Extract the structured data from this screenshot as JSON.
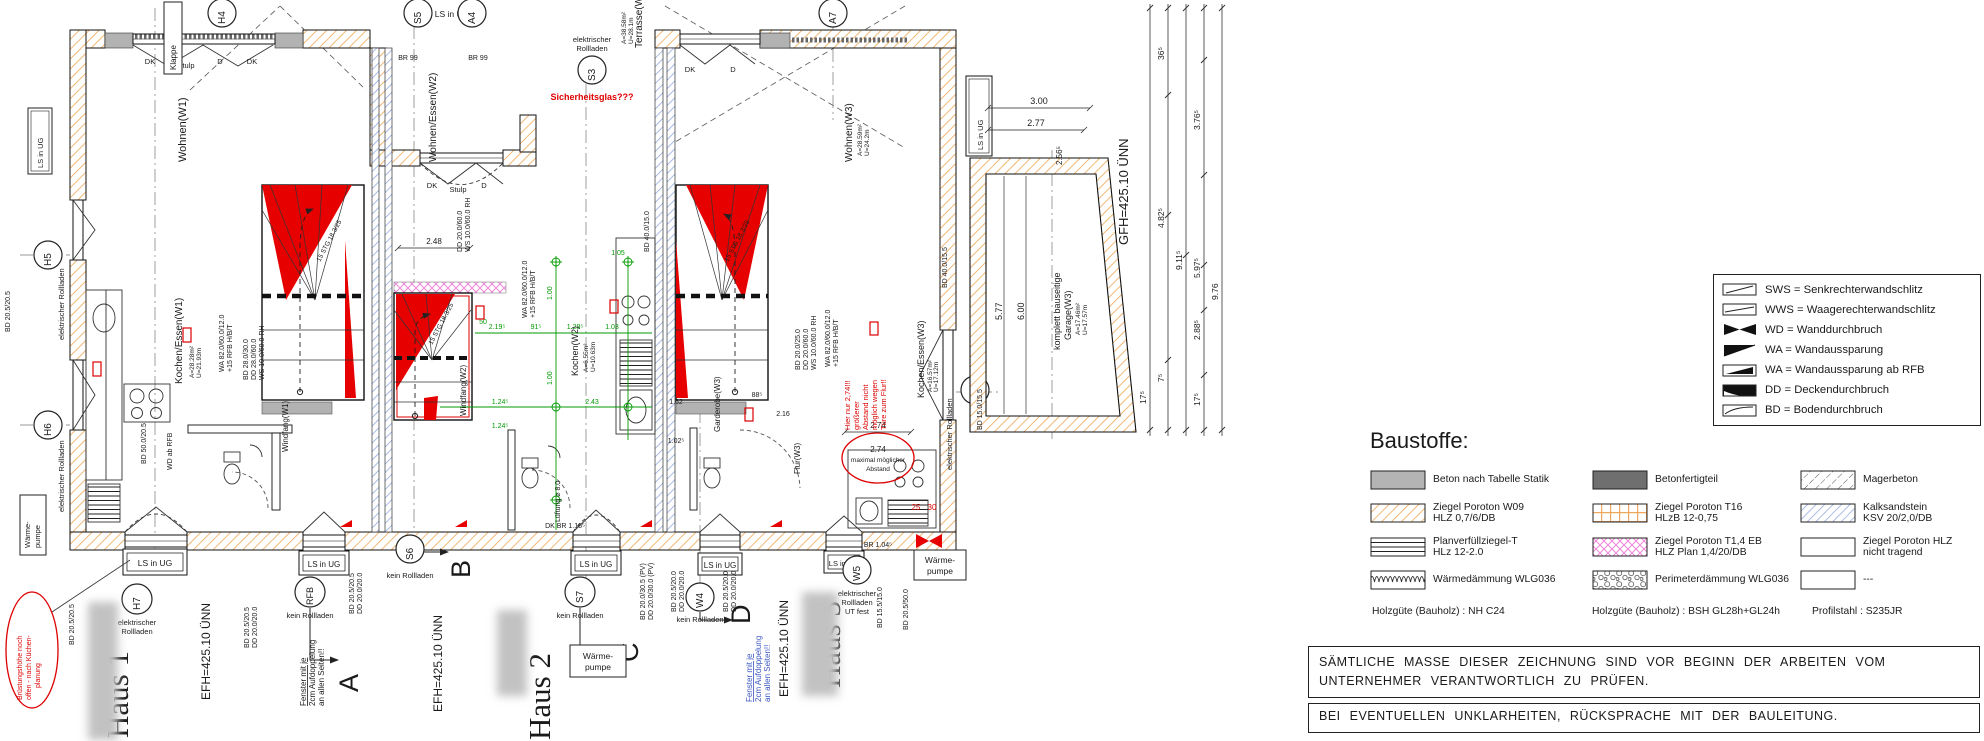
{
  "legend": {
    "rows": [
      {
        "label": "SWS = Senkrechterwandschlitz"
      },
      {
        "label": "WWS = Waagerechterwandschlitz"
      },
      {
        "label": "WD = Wanddurchbruch"
      },
      {
        "label": "WA = Wandaussparung"
      },
      {
        "label": "WA = Wandaussparung ab RFB"
      },
      {
        "label": "DD = Deckendurchbruch"
      },
      {
        "label": "BD = Bodendurchbruch"
      }
    ]
  },
  "baustoffe": {
    "heading": "Baustoffe:",
    "cells": [
      {
        "l1": "Beton nach Tabelle Statik",
        "l2": ""
      },
      {
        "l1": "Betonfertigteil",
        "l2": ""
      },
      {
        "l1": "Magerbeton",
        "l2": ""
      },
      {
        "l1": "Ziegel Poroton W09",
        "l2": "HLZ 0,7/6/DB"
      },
      {
        "l1": "Ziegel Poroton T16",
        "l2": "HLzB 12-0,75"
      },
      {
        "l1": "Kalksandstein",
        "l2": "KSV 20/2,0/DB"
      },
      {
        "l1": "Planverfüllziegel-T",
        "l2": "HLz 12-2.0"
      },
      {
        "l1": "Ziegel Poroton T1,4 EB",
        "l2": "HLZ Plan 1,4/20/DB"
      },
      {
        "l1": "Ziegel Poroton HLZ",
        "l2": "nicht tragend"
      },
      {
        "l1": "Wärmedämmung WLG036",
        "l2": ""
      },
      {
        "l1": "Perimeterdämmung WLG036",
        "l2": ""
      },
      {
        "l1": "---",
        "l2": ""
      }
    ],
    "footer": [
      "Holzgüte (Bauholz) : NH C24",
      "Holzgüte (Bauholz) : BSH GL28h+GL24h",
      "Profilstahl : S235JR"
    ]
  },
  "notes": {
    "l1": "SÄMTLICHE MASSE DIESER ZEICHNUNG SIND VOR BEGINN DER ARBEITEN VOM",
    "l2": "UNTERNEHMER VERANTWORTLICH ZU PRÜFEN.",
    "l3": "BEI EVENTUELLEN UNKLARHEITEN, RÜCKSPRACHE MIT DER BAULEITUNG."
  },
  "plan": {
    "houses": [
      {
        "name": "Haus 1",
        "efh": "EFH=425.10 ÜNN"
      },
      {
        "name": "Haus 2",
        "efh": "EFH=425.10 ÜNN"
      },
      {
        "name": "Haus 3",
        "efh": "EFH=425.10 ÜNN"
      }
    ],
    "garage": {
      "gfh": "GFH=425.10 ÜNN",
      "l1": "komplett bauseitige",
      "l2": "Garage(W3)",
      "a": "A=17.46m²",
      "u": "U=17.57m"
    },
    "rooms": {
      "wohnen1": "Wohnen(W1)",
      "ke1": "Kochen/Essen(W1)",
      "ke1a": "A=28.28m²",
      "ke1u": "U=21.93m",
      "wf1": "Windfang(W1)",
      "we2": "Wohnen/Essen(W2)",
      "ko2": "Kochen(W2)",
      "ko2a": "A=6.55m²",
      "ko2u": "U=10.63m",
      "wf2": "Windfang(W2)",
      "terrasse": "Terrasse(W2)",
      "terra": "A=38.58m²",
      "terru": "U=28.1m",
      "wohnen3": "Wohnen(W3)",
      "w3a": "A=28.59m²",
      "w3u": "U=24.2m",
      "ke3": "Kochen/Essen(W3)",
      "ke3a": "A=16.57m²",
      "ke3u": "U=17.12m",
      "gard3": "Garderobe(W3)",
      "flur3": "Flur(W3)"
    },
    "circles": {
      "h4": "H4",
      "s5": "S5",
      "a4": "A4",
      "s3": "S3",
      "a7": "A7",
      "h5": "H5",
      "h6": "H6",
      "h7": "H7",
      "rfb": "RFB",
      "s6": "S6",
      "s7": "S7",
      "w4": "W4",
      "w5": "W5",
      "w6": "W6"
    },
    "captions": {
      "elektr1": "elektrischer",
      "elektr2": "Rollladen",
      "kein": "kein Rollladen",
      "utfest": "UT fest",
      "elektr": "elektrischer Rollladen"
    },
    "boxes": {
      "ls": "LS in UG",
      "wp1": "Wärme-",
      "wp2": "pumpe",
      "klappe": "Klappe"
    },
    "sections": {
      "a": "A",
      "b": "B",
      "c": "C",
      "d": "D"
    },
    "win": {
      "dk": "DK",
      "stulp": "Stulp",
      "d": "D",
      "br99": "BR 99",
      "br116": "DK BR 1.16⁵",
      "br104": "BR 1.04⁵"
    },
    "stair": {
      "label": "15 STG 18.3/25"
    },
    "red": {
      "glas": "Sicherheitsglas???",
      "h1": "Hier nur 2,74!!!",
      "h2": "größerer",
      "h3": "Abstand nicht",
      "h4": "möglich wegen",
      "h5": "Türe zum Flur!!",
      "c1": "Brüstungshöhe noch",
      "c2": "offen - nach Küchen-",
      "c3": "planung",
      "m1": "maximal möglicher",
      "m2": "Abstand",
      "d25": "25",
      "d30": "30"
    },
    "fenster": {
      "l1": "Fenster mit je",
      "l2": "2cm Aufdoppelung",
      "l3": "an allen Seiten!!"
    },
    "codes": {
      "bd2055": "BD 20.5/20.5",
      "dd2020": "DD 20.0/20.0",
      "bdpv": "BD 20.0/30.5 (PV)",
      "ddpv": "DD 20.0/30.0 (PV)",
      "bd2050x": "BD 20.5/20.0",
      "bd1515": "BD 15.5/15.0",
      "bd2050": "BD 20.5/50.0",
      "bd5020": "BD 50.0/20.5",
      "wa82": "WA 82.0/60.0/12.0",
      "rfb15": "+15 RFB H/B/T",
      "bd2830": "BD 28.0/30.0",
      "dd2860": "DD 28.0/60.0",
      "ws10": "WS 10.0/60.0 RH",
      "bd2025": "BD 20.0/25.0",
      "dd2060": "DD 20.0/60.0",
      "bd4015": "BD 40.0/15.5",
      "bd4010": "BD 40.0/15.0",
      "bd1505": "BD 15.0/15.5",
      "wdrfb": "WD ab RFB",
      "lueft": "Lüftung ⌀ 8.0"
    },
    "dims": {
      "d300": "3.00",
      "d277": "2.77",
      "d256": "2.56⁵",
      "d577": "5.77",
      "d600": "6.00",
      "d976": "9.76",
      "d376": "3.76⁵",
      "d597": "5.97⁵",
      "d288": "2.88⁵",
      "d482": "4.82⁵",
      "d911": "9.11⁵",
      "d36": "36⁵",
      "d17": "17⁵",
      "d7": "7⁵",
      "d248": "2.48",
      "d219": "2.19⁵",
      "d124": "1.24⁵",
      "d91": "91⁵",
      "d128": "1.28⁵",
      "d103": "1.03",
      "d100": "1.00",
      "d243": "2.43",
      "d105": "1.05",
      "d50": "50",
      "d274": "2.74",
      "d162": "1.62",
      "d216": "2.16",
      "d102": "1.02⁵",
      "d88": "88⁵"
    }
  }
}
